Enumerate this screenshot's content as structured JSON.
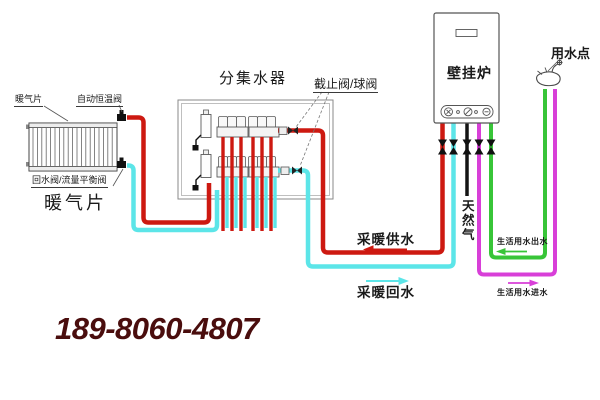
{
  "labels": {
    "radiator_small": "暖气片",
    "thermostatic_valve": "自动恒温阀",
    "return_valve": "回水阀/流量平衡阀",
    "radiator_large": "暖气片",
    "manifold": "分集水器",
    "stop_valve": "截止阀/球阀",
    "boiler": "壁挂炉",
    "tap": "用水点",
    "gas": "天然气",
    "heating_supply": "采暖供水",
    "heating_return": "采暖回水",
    "dhw_outlet": "生活用水出水",
    "dhw_inlet": "生活用水进水"
  },
  "phone": "189-8060-4807",
  "colors": {
    "heating_supply": "#cd1911",
    "heating_return": "#5ce5e8",
    "dhw_inlet": "#d83fd8",
    "dhw_outlet": "#38c538",
    "gas": "#141414",
    "phone": "#4a0d0d"
  }
}
